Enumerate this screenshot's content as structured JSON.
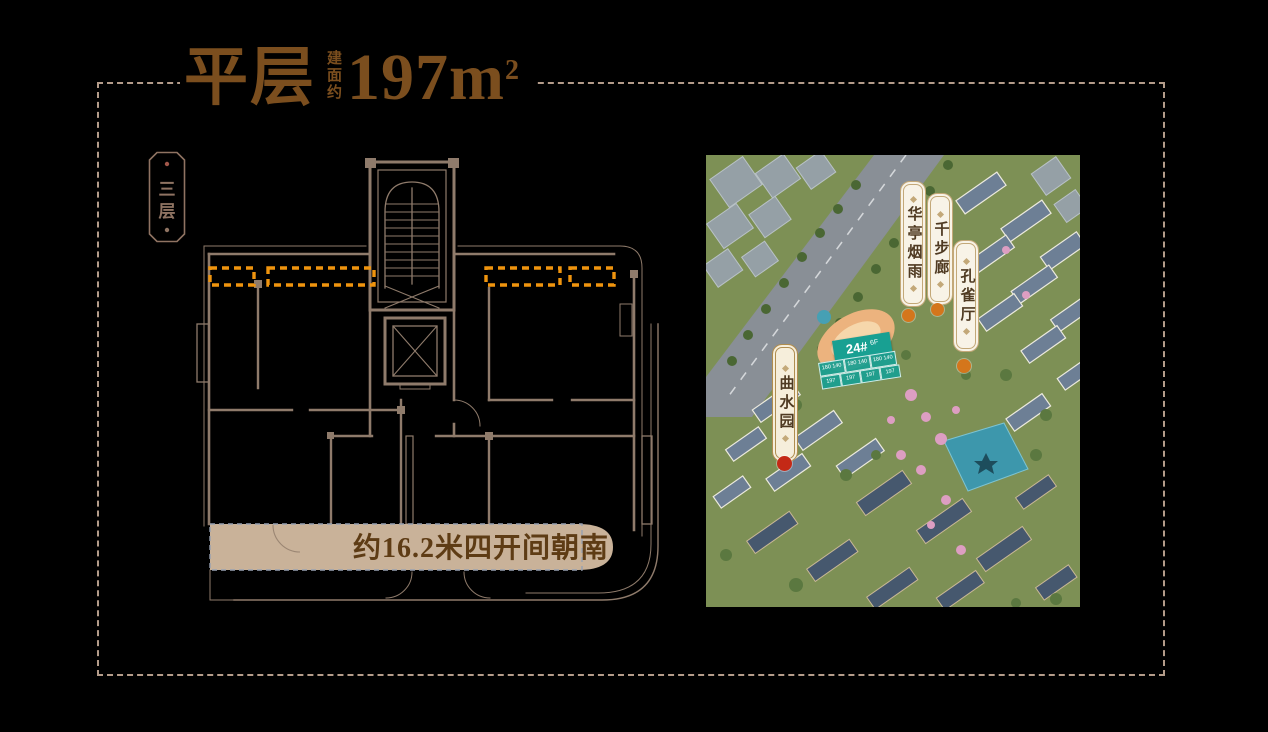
{
  "header": {
    "title": "平层",
    "area_prefix": "建面约",
    "area_value": "197m",
    "area_sup": "2"
  },
  "floor_tag": {
    "label": "三层"
  },
  "floorplan": {
    "south_label": "约16.2米四开间朝南"
  },
  "aerial": {
    "plaques": [
      {
        "text": "华亭烟雨",
        "variant": "ivory",
        "dot_color": "#d4761c"
      },
      {
        "text": "千步廊",
        "variant": "ivory",
        "dot_color": "#d4761c"
      },
      {
        "text": "孔雀厅",
        "variant": "ivory",
        "dot_color": "#d4761c"
      },
      {
        "text": "曲水园",
        "variant": "gold",
        "dot_color": "#c42916"
      }
    ],
    "building_banner": {
      "label": "24#",
      "floors": "6F"
    },
    "unit_grid": {
      "rows": [
        [
          "180 140",
          "180 140",
          "180 140"
        ],
        [
          "197",
          "197",
          "197",
          "197"
        ]
      ]
    }
  },
  "colors": {
    "c-frame": "#b49c8a",
    "c-title": "#7b4e1e",
    "c-plan": "#8f7b6b",
    "c-orange": "#ef940e",
    "c-band": "#c9b299",
    "c-bandtext": "#5e3c15",
    "c-tag": "#8f7362",
    "c-plaqueborder": "#c3a878",
    "c-plaquetext": "#4f3a22",
    "c-teal": "#18a092"
  }
}
